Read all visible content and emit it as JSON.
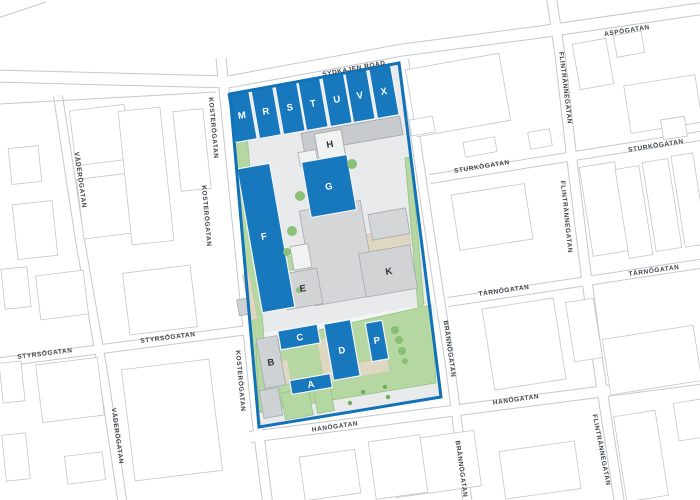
{
  "map": {
    "title": "Site plan map",
    "streets": {
      "sydkajen_road": "SYDKAJEN ROAD",
      "aspogatan": "ASPÖGATAN",
      "flintrannegatan": "FLINTRÄNNEGATAN",
      "sturkogatan": "STURKÖGATAN",
      "tarnogatan": "TÄRNÖGATAN",
      "hanogatan": "HANÖGATAN",
      "brannogatan": "BRÄNNÖGATAN",
      "kosterogatan": "KOSTERÖGATAN",
      "vaderogatan": "VÄDERÖGATAN",
      "styrsogatan": "STYRSÖGATAN"
    },
    "buildings": {
      "m": "M",
      "r": "R",
      "s": "S",
      "t": "T",
      "u": "U",
      "v": "V",
      "x": "X",
      "g": "G",
      "f": "F",
      "c": "C",
      "d": "D",
      "p": "P",
      "a": "A",
      "h": "H",
      "e": "E",
      "k": "K",
      "b": "B"
    },
    "colors": {
      "site_boundary": "#1172b8",
      "building_highlight": "#1878bd",
      "building_secondary": "#d2d4d6",
      "building_light": "#f1f2f2",
      "green_space": "#b5d8a3",
      "tree": "#85bf72",
      "site_ground": "#e9eaeb",
      "beige": "#ded8c2",
      "road_line": "#c5c9cc",
      "street_label_text": "#3f4449",
      "building_label_dark": "#2f353a",
      "building_label_light": "#ffffff"
    }
  }
}
